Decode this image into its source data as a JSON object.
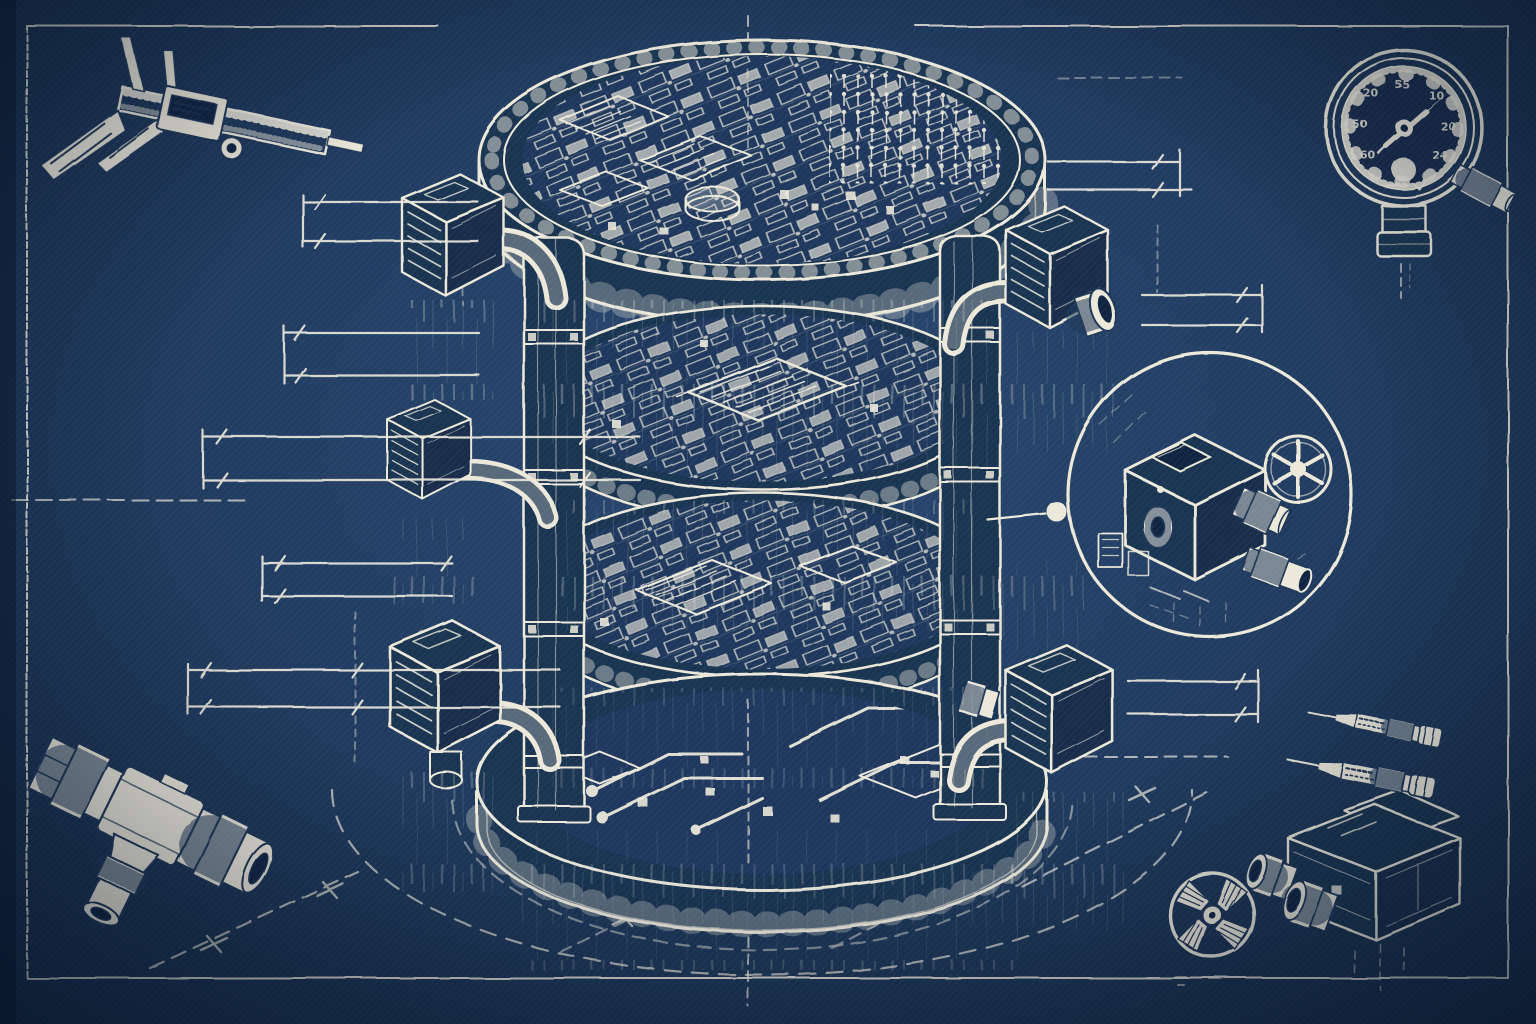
{
  "scene": {
    "type": "blueprint technical illustration",
    "subject": "Exploded isometric cylinder of stacked circuit-board layers with drafting instruments and dimension lines",
    "palette": {
      "background": "#1e3a60",
      "background_deep": "#122947",
      "ink": "#ece8da"
    }
  },
  "gauge": {
    "dial_numbers": [
      {
        "value": "20"
      },
      {
        "value": "55"
      },
      {
        "value": "10"
      },
      {
        "value": "20"
      },
      {
        "value": "24"
      },
      {
        "value": "50"
      },
      {
        "value": "60"
      }
    ]
  },
  "parts": {
    "top_left": "vernier-caliper-icon",
    "top_right": "pressure-gauge-icon",
    "middle_right": "magnified-detail-circle",
    "bottom_left": "tee-pipe-fitting-icon",
    "bottom_right_symbol": "radiation-fan-icon",
    "bottom_right_component": "twin-port-connector-block-icon",
    "right_side": "probe-pin-icons",
    "center": "stacked-circuit-cylinder"
  }
}
